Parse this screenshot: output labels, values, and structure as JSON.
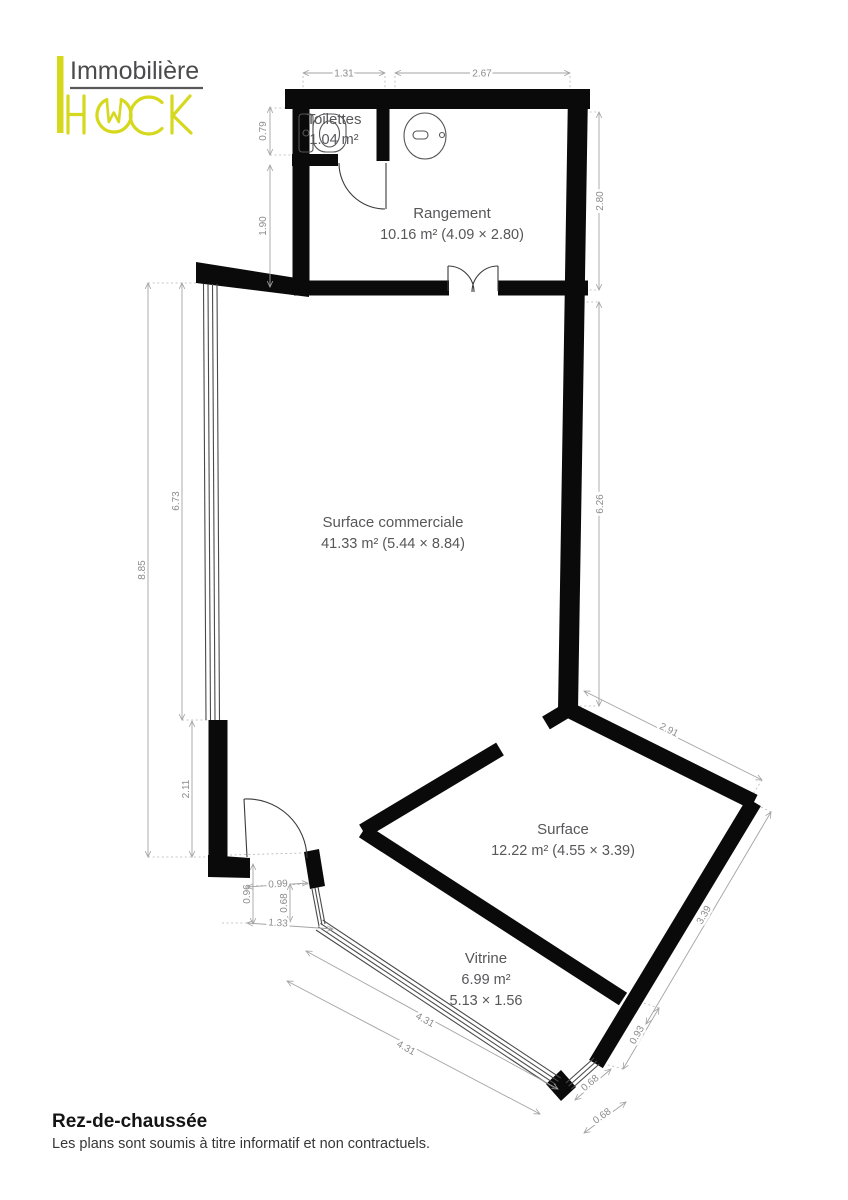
{
  "logo": {
    "name": "Immobilière",
    "brand": "HACK"
  },
  "plan": {
    "rooms": [
      {
        "name": "Toilettes",
        "area": "1.04 m²"
      },
      {
        "name": "Rangement",
        "area": "10.16 m² (4.09 × 2.80)"
      },
      {
        "name": "Surface commerciale",
        "area": "41.33 m² (5.44 × 8.84)"
      },
      {
        "name": "Surface",
        "area": "12.22 m² (4.55 × 3.39)"
      },
      {
        "name": "Vitrine",
        "area": "6.99 m²",
        "size": "5.13 × 1.56"
      }
    ],
    "dimensions": [
      {
        "value": "1.31"
      },
      {
        "value": "2.67"
      },
      {
        "value": "0.79"
      },
      {
        "value": "1.90"
      },
      {
        "value": "2.80"
      },
      {
        "value": "6.26"
      },
      {
        "value": "8.85"
      },
      {
        "value": "6.73"
      },
      {
        "value": "2.11"
      },
      {
        "value": "0.96"
      },
      {
        "value": "0.99"
      },
      {
        "value": "0.68"
      },
      {
        "value": "1.33"
      },
      {
        "value": "2.91"
      },
      {
        "value": "3.39"
      },
      {
        "value": "0.93"
      },
      {
        "value": "0.68"
      },
      {
        "value": "0.68"
      },
      {
        "value": "4.31"
      },
      {
        "value": "4.31"
      }
    ]
  },
  "footer": {
    "title": "Rez-de-chaussée",
    "disclaimer": "Les plans sont soumis à titre informatif et non contractuels."
  },
  "colors": {
    "accent": "#d6d81e",
    "wall": "#0a0a0a",
    "dim_line": "#a3a3a3",
    "room_text": "#57575a"
  }
}
